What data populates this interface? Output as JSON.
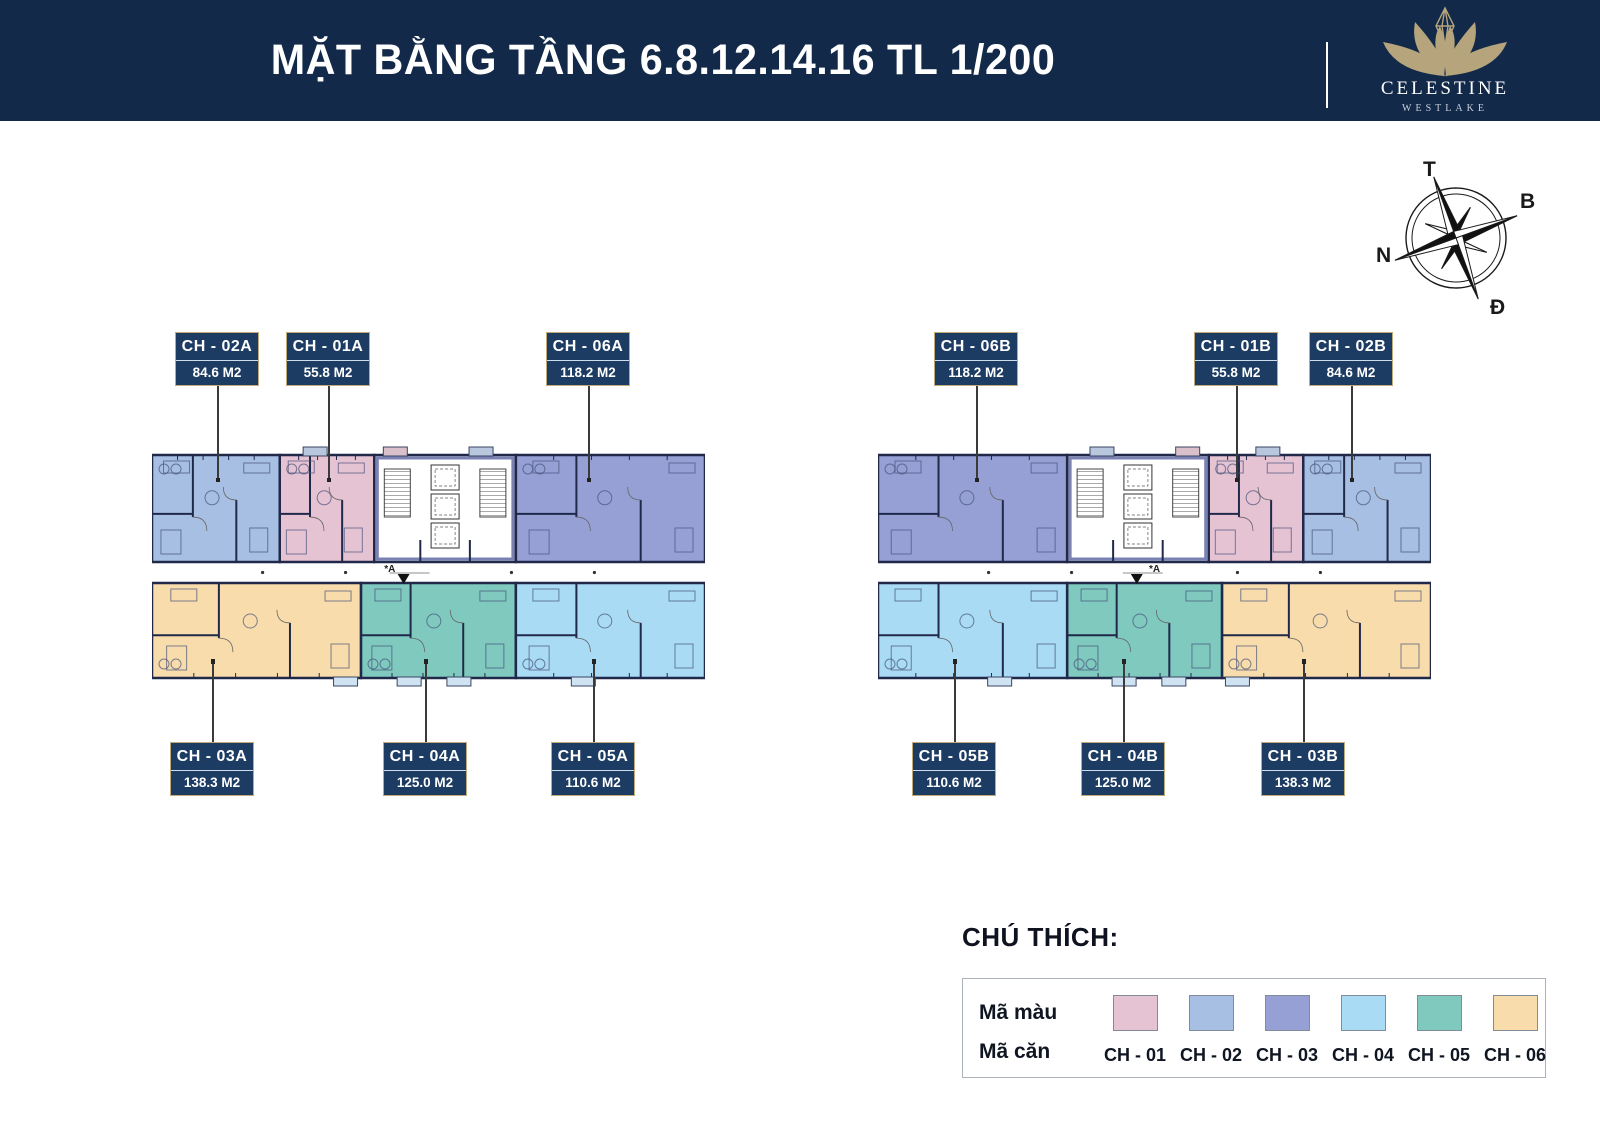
{
  "header": {
    "title": "MẶT BẰNG TẦNG 6.8.12.14.16 TL 1/200",
    "brand": {
      "name": "CELESTINE",
      "sub": "WESTLAKE"
    }
  },
  "compass": {
    "top": "T",
    "right": "B",
    "left": "N",
    "bottom": "Đ"
  },
  "section_mark": "A",
  "colors": {
    "header_bg": "#12294a",
    "label_bg": "#1d3c63",
    "label_border": "#c2aa77",
    "wall": "#20294a",
    "logo_gold": "#b5a47c",
    "pink": "#e6c3d3",
    "periwinkle": "#a7bfe2",
    "purple": "#96a0d5",
    "sky": "#a9dbf4",
    "teal": "#7fc9be",
    "tan": "#f8dcab",
    "tab_blue": "#b9c7de",
    "tab_pink": "#d9c0cb",
    "tab_sky": "#cfe3f2"
  },
  "plan": {
    "width": 553,
    "top_h": 107,
    "gap_h": 21,
    "bottom_h": 95,
    "top_units": [
      {
        "key": "periwinkle",
        "x0": 0.0,
        "x1": 0.231
      },
      {
        "key": "pink",
        "x0": 0.231,
        "x1": 0.402
      },
      {
        "key": "core",
        "x0": 0.402,
        "x1": 0.658
      },
      {
        "key": "purple",
        "x0": 0.658,
        "x1": 1.0
      }
    ],
    "bottom_units": [
      {
        "key": "tan",
        "x0": 0.0,
        "x1": 0.378
      },
      {
        "key": "teal",
        "x0": 0.378,
        "x1": 0.658
      },
      {
        "key": "sky",
        "x0": 0.658,
        "x1": 1.0
      }
    ],
    "top_tabs": [
      {
        "f": 0.295,
        "c": "tab_blue"
      },
      {
        "f": 0.44,
        "c": "tab_pink"
      },
      {
        "f": 0.595,
        "c": "tab_blue"
      }
    ],
    "bottom_tabs": [
      {
        "f": 0.35,
        "c": "tab_sky"
      },
      {
        "f": 0.465,
        "c": "tab_sky"
      },
      {
        "f": 0.555,
        "c": "tab_sky"
      },
      {
        "f": 0.78,
        "c": "tab_sky"
      }
    ]
  },
  "blocks": [
    {
      "name": "block-a",
      "x": 152,
      "y": 455,
      "mirrored": false,
      "arrow_f": 0.455,
      "amark_f": 0.42
    },
    {
      "name": "block-b",
      "x": 878,
      "y": 455,
      "mirrored": true,
      "arrow_f": 0.468,
      "amark_f": 0.49
    }
  ],
  "unit_labels": [
    {
      "code": "CH - 02A",
      "area": "84.6 M2",
      "cx": 217,
      "side": "top"
    },
    {
      "code": "CH - 01A",
      "area": "55.8 M2",
      "cx": 328,
      "side": "top"
    },
    {
      "code": "CH - 06A",
      "area": "118.2 M2",
      "cx": 588,
      "side": "top"
    },
    {
      "code": "CH - 06B",
      "area": "118.2 M2",
      "cx": 976,
      "side": "top"
    },
    {
      "code": "CH - 01B",
      "area": "55.8 M2",
      "cx": 1236,
      "side": "top"
    },
    {
      "code": "CH - 02B",
      "area": "84.6 M2",
      "cx": 1351,
      "side": "top"
    },
    {
      "code": "CH - 03A",
      "area": "138.3 M2",
      "cx": 212,
      "side": "bottom"
    },
    {
      "code": "CH - 04A",
      "area": "125.0 M2",
      "cx": 425,
      "side": "bottom"
    },
    {
      "code": "CH - 05A",
      "area": "110.6 M2",
      "cx": 593,
      "side": "bottom"
    },
    {
      "code": "CH - 05B",
      "area": "110.6 M2",
      "cx": 954,
      "side": "bottom"
    },
    {
      "code": "CH - 04B",
      "area": "125.0 M2",
      "cx": 1123,
      "side": "bottom"
    },
    {
      "code": "CH - 03B",
      "area": "138.3 M2",
      "cx": 1303,
      "side": "bottom"
    }
  ],
  "legend": {
    "heading": "CHÚ THÍCH:",
    "color_row_label": "Mã màu",
    "unit_row_label": "Mã căn",
    "items": [
      {
        "code": "CH - 01",
        "color_key": "pink"
      },
      {
        "code": "CH - 02",
        "color_key": "periwinkle"
      },
      {
        "code": "CH - 03",
        "color_key": "purple"
      },
      {
        "code": "CH - 04",
        "color_key": "sky"
      },
      {
        "code": "CH - 05",
        "color_key": "teal"
      },
      {
        "code": "CH - 06",
        "color_key": "tan"
      }
    ]
  }
}
